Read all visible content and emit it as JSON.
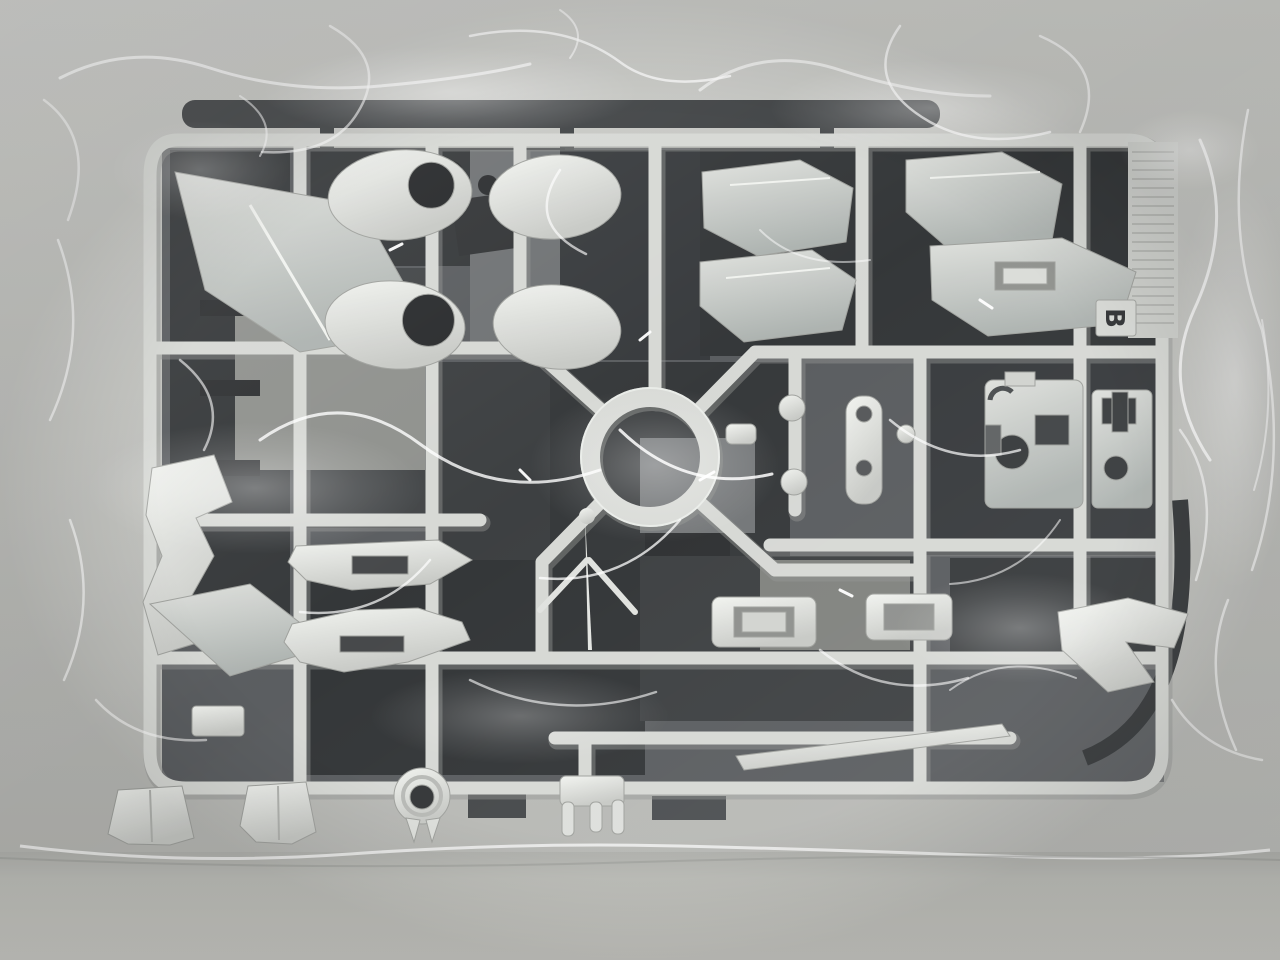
{
  "scene": {
    "runner_tab_label": "B",
    "colors": {
      "table_surface": "#c1c2be",
      "table_bottom": "#bcbdb8",
      "plastic_white_rail": "#d5d7d3",
      "plastic_part_light": "#eef0ec",
      "runner_dark": "#2e3133",
      "runner_dark_base": "#54575a",
      "bag_highlight": "#ffffff"
    }
  }
}
